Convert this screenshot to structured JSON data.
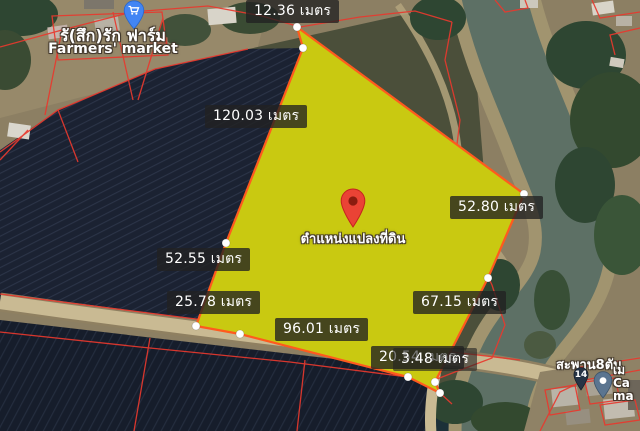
{
  "map": {
    "type": "satellite-parcel-map",
    "measurements": {
      "top": "12.36 เมตร",
      "left_upper": "120.03 เมตร",
      "right_upper": "52.80 เมตร",
      "left_mid": "52.55 เมตร",
      "left_lower": "25.78 เมตร",
      "bottom": "96.01 เมตร",
      "right_lower": "67.15 เมตร",
      "bottom_right_a": "20.54 เมตร",
      "bottom_right_b": "3.48 เมตร"
    },
    "plot_marker": {
      "caption": "ตำแหน่งแปลงที่ดิน"
    },
    "poi_market": {
      "name_th": "รั(สึก)รัก ฟาร์ม",
      "name_en": "Farmers' market"
    },
    "bridge": {
      "label": "สะพาน8ตัน",
      "pin_number": "14"
    },
    "edge_label": {
      "line1": "เม",
      "line2": "Ca",
      "line3": "ma"
    },
    "colors": {
      "plot_fill": "#e8e000",
      "plot_stroke": "#ff5a1e",
      "parcel_line": "#e8392e",
      "marker_red": "#ea4335",
      "poi_blue": "#4285f4",
      "river_water": "#5d7065"
    }
  }
}
